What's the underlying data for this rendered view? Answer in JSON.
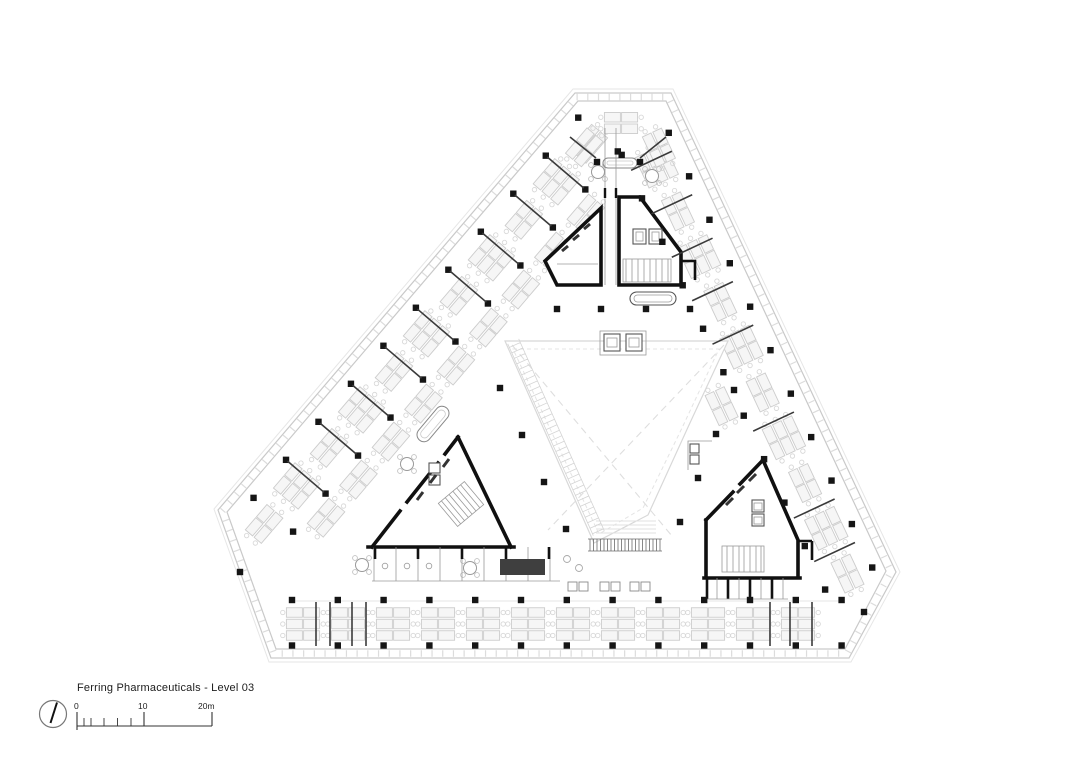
{
  "drawing": {
    "title": "Ferring Pharmaceuticals - Level 03",
    "project": "Ferring Pharmaceuticals",
    "level": "Level 03",
    "scale_bar": {
      "label_start": "0",
      "label_mid": "10",
      "label_end": "20m"
    },
    "icons": {
      "north_arrow": "north-arrow"
    }
  },
  "colors": {
    "background": "#ffffff",
    "ink": "#151515",
    "wall": "#101010",
    "partition": "#3a3a3a",
    "furniture_line": "#cccccc",
    "facade_line": "#c9c9c9",
    "faint_line": "#e2e2e2"
  }
}
